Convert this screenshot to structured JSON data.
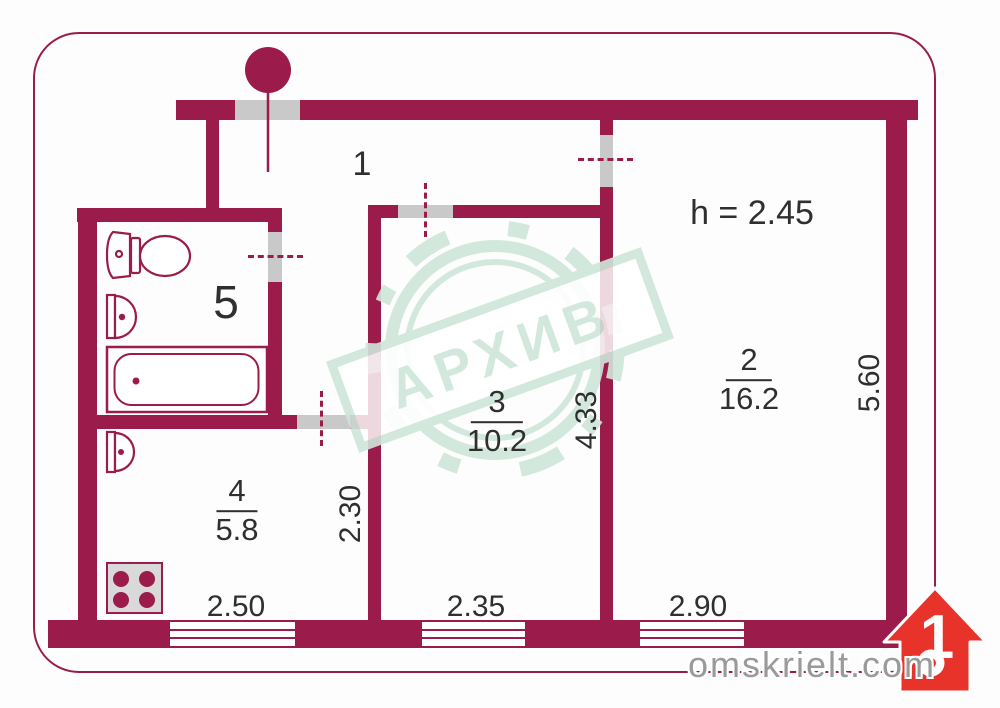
{
  "colors": {
    "wall": "#9b1b4b",
    "door_jamb": "#c9c9c9",
    "stamp": "#cfe6da",
    "logo_red": "#e8332b",
    "text": "#2f2f2f",
    "brand_text": "#9a9a9a"
  },
  "rooms": [
    {
      "number": "1"
    },
    {
      "number": "2",
      "area": "16.2"
    },
    {
      "number": "3",
      "area": "10.2"
    },
    {
      "number": "4",
      "area": "5.8"
    },
    {
      "number": "5"
    }
  ],
  "ceiling_height": "h = 2.45",
  "dimensions": {
    "kitchen_width": "2.50",
    "room3_width": "2.35",
    "room2_width": "2.90",
    "kitchen_depth": "2.30",
    "room3_depth": "4.33",
    "room2_depth": "5.60"
  },
  "watermark": {
    "stamp": "АРХИВ",
    "brand_name": "omskrielt",
    "brand_tld": ".com",
    "logo_number": "1"
  }
}
